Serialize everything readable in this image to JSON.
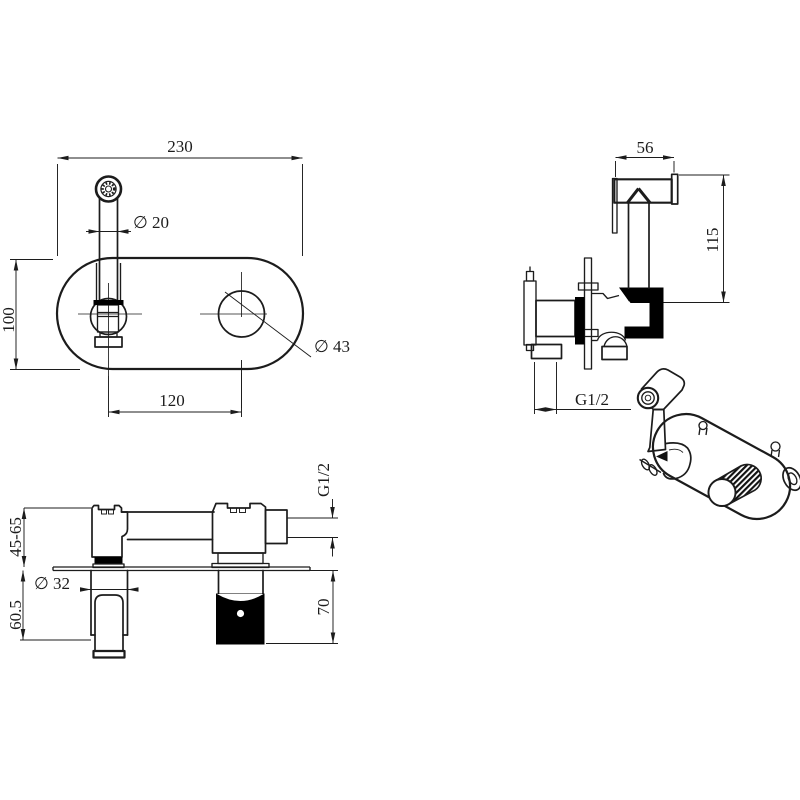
{
  "drawing": {
    "front_view": {
      "plate_width": "230",
      "sprayer_diameter": "∅ 20",
      "plate_height": "100",
      "hole_diameter": "∅ 43",
      "hole_spacing": "120"
    },
    "side_view": {
      "head_length": "56",
      "overall_height": "115",
      "inlet_thread": "G1/2"
    },
    "section_view": {
      "mounting_depth": "45-65",
      "handle_projection": "60.5",
      "handle_diameter": "∅ 32",
      "outlet_thread": "G1/2",
      "body_length": "70"
    },
    "colors": {
      "background": "#ffffff",
      "line": "#1c1c1c",
      "solid_fill": "#000000"
    }
  }
}
